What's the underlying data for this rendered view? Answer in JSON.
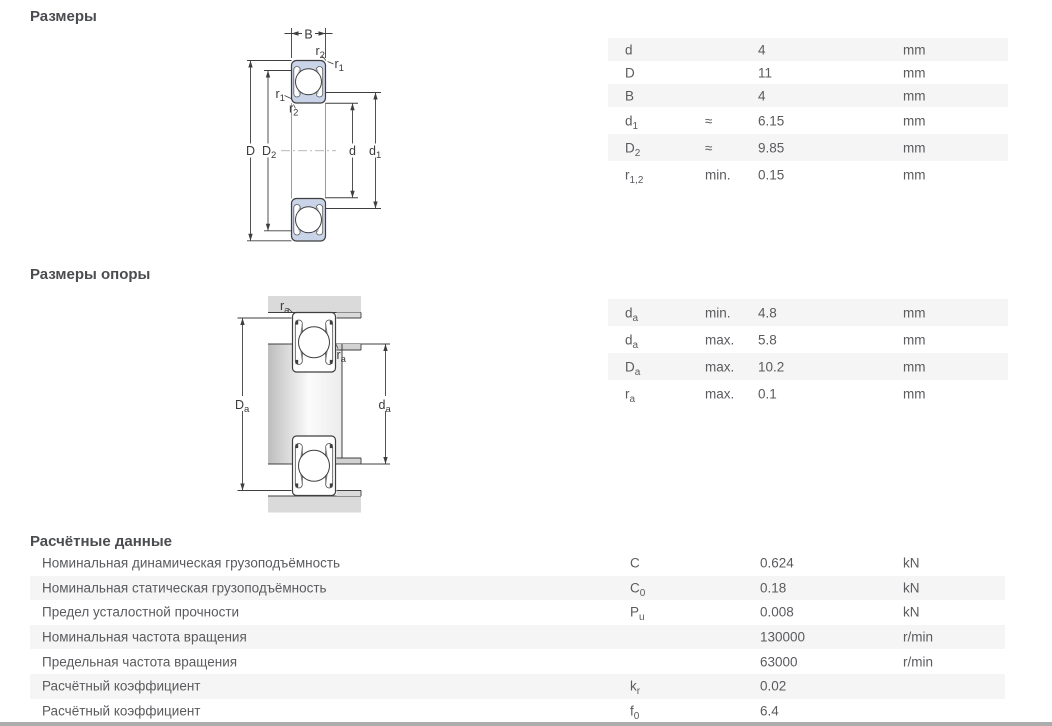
{
  "section_dimensions": {
    "title": "Размеры",
    "table": {
      "rows": [
        {
          "sym": {
            "base": "d",
            "sub": ""
          },
          "qual": "",
          "value": "4",
          "unit": "mm"
        },
        {
          "sym": {
            "base": "D",
            "sub": ""
          },
          "qual": "",
          "value": "11",
          "unit": "mm"
        },
        {
          "sym": {
            "base": "B",
            "sub": ""
          },
          "qual": "",
          "value": "4",
          "unit": "mm"
        },
        {
          "sym": {
            "base": "d",
            "sub": "1"
          },
          "qual": "≈",
          "value": "6.15",
          "unit": "mm"
        },
        {
          "sym": {
            "base": "D",
            "sub": "2"
          },
          "qual": "≈",
          "value": "9.85",
          "unit": "mm"
        },
        {
          "sym": {
            "base": "r",
            "sub": "1,2"
          },
          "qual": "min.",
          "value": "0.15",
          "unit": "mm"
        }
      ]
    }
  },
  "section_abutment": {
    "title": "Размеры опоры",
    "table": {
      "rows": [
        {
          "sym": {
            "base": "d",
            "sub": "a"
          },
          "qual": "min.",
          "value": "4.8",
          "unit": "mm"
        },
        {
          "sym": {
            "base": "d",
            "sub": "a"
          },
          "qual": "max.",
          "value": "5.8",
          "unit": "mm"
        },
        {
          "sym": {
            "base": "D",
            "sub": "a"
          },
          "qual": "max.",
          "value": "10.2",
          "unit": "mm"
        },
        {
          "sym": {
            "base": "r",
            "sub": "a"
          },
          "qual": "max.",
          "value": "0.1",
          "unit": "mm"
        }
      ]
    }
  },
  "section_calc": {
    "title": "Расчётные данные",
    "table": {
      "rows": [
        {
          "label": "Номинальная динамическая грузоподъёмность",
          "sym": {
            "base": "C",
            "sub": ""
          },
          "value": "0.624",
          "unit": "kN"
        },
        {
          "label": "Номинальная статическая грузоподъёмность",
          "sym": {
            "base": "C",
            "sub": "0"
          },
          "value": "0.18",
          "unit": "kN"
        },
        {
          "label": "Предел усталостной прочности",
          "sym": {
            "base": "P",
            "sub": "u"
          },
          "value": "0.008",
          "unit": "kN"
        },
        {
          "label": "Номинальная частота вращения",
          "sym": {
            "base": "",
            "sub": ""
          },
          "value": "130000",
          "unit": "r/min"
        },
        {
          "label": "Предельная частота вращения",
          "sym": {
            "base": "",
            "sub": ""
          },
          "value": "63000",
          "unit": "r/min"
        },
        {
          "label": "Расчётный коэффициент",
          "sym": {
            "base": "k",
            "sub": "r"
          },
          "value": "0.02",
          "unit": ""
        },
        {
          "label": "Расчётный коэффициент",
          "sym": {
            "base": "f",
            "sub": "0"
          },
          "value": "6.4",
          "unit": ""
        }
      ]
    }
  },
  "dim_labels": {
    "B": {
      "base": "B",
      "sub": ""
    },
    "D": {
      "base": "D",
      "sub": ""
    },
    "D2": {
      "base": "D",
      "sub": "2"
    },
    "d": {
      "base": "d",
      "sub": ""
    },
    "d1": {
      "base": "d",
      "sub": "1"
    },
    "r1": {
      "base": "r",
      "sub": "1"
    },
    "r2": {
      "base": "r",
      "sub": "2"
    },
    "Da": {
      "base": "D",
      "sub": "a"
    },
    "da": {
      "base": "d",
      "sub": "a"
    },
    "ra": {
      "base": "r",
      "sub": "a"
    }
  },
  "colors": {
    "row_alt": "#f5f5f5",
    "table_text": "#5a5b5e",
    "heading_text": "#4b4c4f",
    "bearing_shield_fill": "#c9d4e8",
    "metal_gray": "#dadada",
    "line": "#3f3f3f"
  }
}
